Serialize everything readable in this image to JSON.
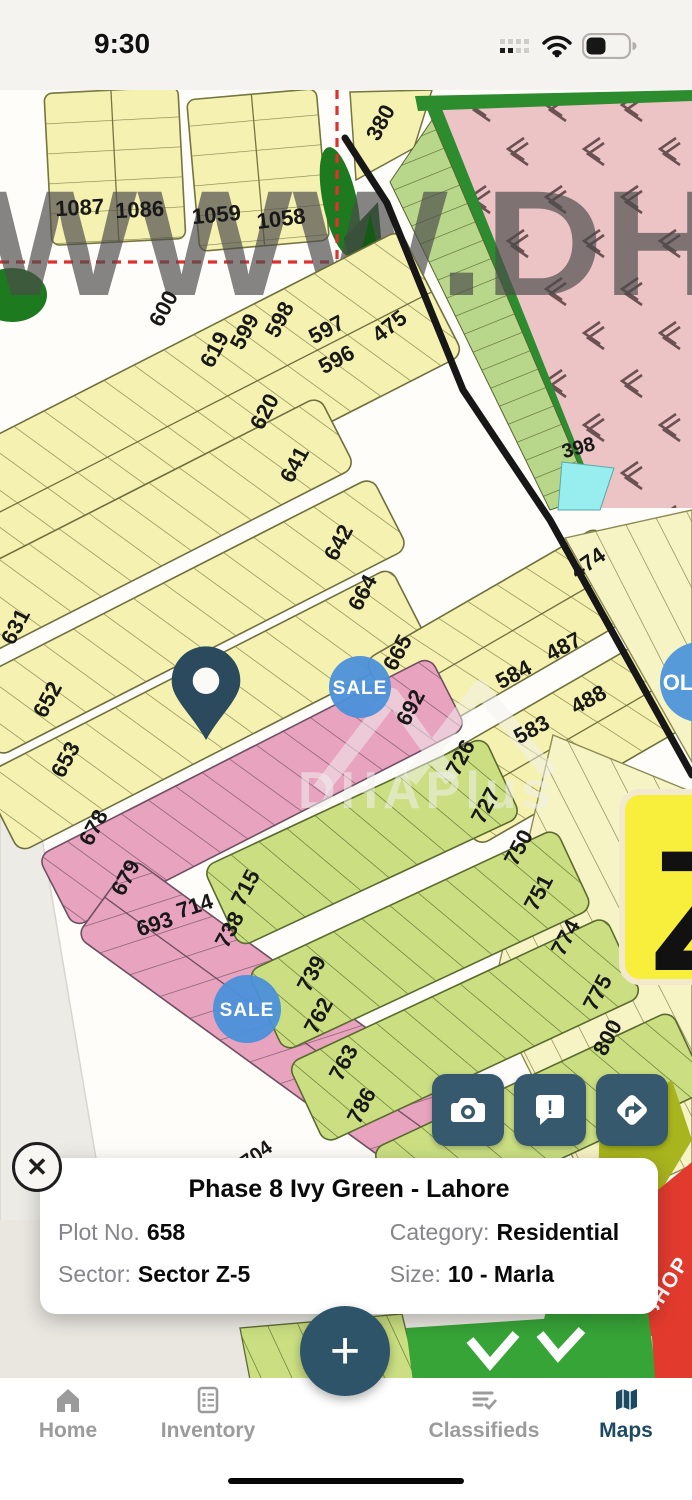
{
  "status_bar": {
    "time": "9:30"
  },
  "watermark": {
    "large": "WWW.DH",
    "brand": "DHAPlus"
  },
  "map": {
    "sale_badge": "SALE",
    "listing_badge": "OL",
    "shop_label": "SHOP",
    "sector_overlay": "Z",
    "plot_labels": [
      {
        "t": "1087",
        "x": 80,
        "y": 125,
        "r": -3
      },
      {
        "t": "1086",
        "x": 140,
        "y": 127,
        "r": -3
      },
      {
        "t": "1059",
        "x": 217,
        "y": 132,
        "r": -5
      },
      {
        "t": "1058",
        "x": 282,
        "y": 136,
        "r": -7
      },
      {
        "t": "380",
        "x": 387,
        "y": 36,
        "r": -62
      },
      {
        "t": "600",
        "x": 170,
        "y": 222,
        "r": -62
      },
      {
        "t": "619",
        "x": 221,
        "y": 263,
        "r": -62
      },
      {
        "t": "599",
        "x": 251,
        "y": 245,
        "r": -62
      },
      {
        "t": "598",
        "x": 286,
        "y": 233,
        "r": -62
      },
      {
        "t": "597",
        "x": 330,
        "y": 246,
        "r": -28
      },
      {
        "t": "596",
        "x": 340,
        "y": 276,
        "r": -28
      },
      {
        "t": "475",
        "x": 394,
        "y": 242,
        "r": -38
      },
      {
        "t": "620",
        "x": 271,
        "y": 325,
        "r": -62
      },
      {
        "t": "641",
        "x": 301,
        "y": 378,
        "r": -62
      },
      {
        "t": "631",
        "x": 22,
        "y": 540,
        "r": -62
      },
      {
        "t": "642",
        "x": 345,
        "y": 456,
        "r": -62
      },
      {
        "t": "664",
        "x": 369,
        "y": 506,
        "r": -62
      },
      {
        "t": "652",
        "x": 54,
        "y": 613,
        "r": -62
      },
      {
        "t": "653",
        "x": 72,
        "y": 673,
        "r": -62
      },
      {
        "t": "665",
        "x": 404,
        "y": 566,
        "r": -62
      },
      {
        "t": "692",
        "x": 417,
        "y": 621,
        "r": -62
      },
      {
        "t": "678",
        "x": 100,
        "y": 741,
        "r": -62
      },
      {
        "t": "679",
        "x": 132,
        "y": 791,
        "r": -62
      },
      {
        "t": "693",
        "x": 157,
        "y": 841,
        "r": -18
      },
      {
        "t": "714",
        "x": 197,
        "y": 823,
        "r": -18
      },
      {
        "t": "704",
        "x": 260,
        "y": 1070,
        "r": -35,
        "s": 20
      },
      {
        "t": "715",
        "x": 252,
        "y": 801,
        "r": -62
      },
      {
        "t": "738",
        "x": 236,
        "y": 843,
        "r": -62
      },
      {
        "t": "726",
        "x": 467,
        "y": 671,
        "r": -62
      },
      {
        "t": "727",
        "x": 492,
        "y": 719,
        "r": -62
      },
      {
        "t": "739",
        "x": 318,
        "y": 887,
        "r": -62
      },
      {
        "t": "762",
        "x": 325,
        "y": 929,
        "r": -62
      },
      {
        "t": "750",
        "x": 525,
        "y": 761,
        "r": -62
      },
      {
        "t": "751",
        "x": 545,
        "y": 806,
        "r": -62
      },
      {
        "t": "763",
        "x": 350,
        "y": 976,
        "r": -62
      },
      {
        "t": "786",
        "x": 368,
        "y": 1019,
        "r": -62
      },
      {
        "t": "774",
        "x": 572,
        "y": 851,
        "r": -62
      },
      {
        "t": "775",
        "x": 604,
        "y": 906,
        "r": -62
      },
      {
        "t": "800",
        "x": 614,
        "y": 951,
        "r": -62
      },
      {
        "t": "474",
        "x": 592,
        "y": 479,
        "r": -35
      },
      {
        "t": "584",
        "x": 517,
        "y": 591,
        "r": -28
      },
      {
        "t": "487",
        "x": 567,
        "y": 563,
        "r": -28
      },
      {
        "t": "583",
        "x": 535,
        "y": 646,
        "r": -28
      },
      {
        "t": "488",
        "x": 592,
        "y": 616,
        "r": -28
      },
      {
        "t": "398",
        "x": 580,
        "y": 364,
        "r": -15,
        "s": 20
      }
    ]
  },
  "info_card": {
    "title": "Phase 8 Ivy Green - Lahore",
    "close_label": "✕",
    "fields": [
      {
        "label": "Plot No.",
        "value": "658"
      },
      {
        "label": "Category:",
        "value": "Residential"
      },
      {
        "label": "Sector:",
        "value": "Sector Z-5"
      },
      {
        "label": "Size:",
        "value": "10 - Marla"
      }
    ]
  },
  "fab": {
    "label": "+"
  },
  "tab_bar": {
    "items": [
      {
        "label": "Home",
        "active": false
      },
      {
        "label": "Inventory",
        "active": false
      },
      {
        "label": "Classifieds",
        "active": false
      },
      {
        "label": "Maps",
        "active": true
      }
    ]
  },
  "colors": {
    "accent_slate": "#36596e",
    "pin": "#2b4a5e",
    "sale_blue": "#4b90d9",
    "plot_yellow": "#f5f1b0",
    "plot_pink": "#e8a3be",
    "plot_green": "#cbdf82",
    "cemetery_rose": "#ecc4c6",
    "border_green": "#2d8c2e",
    "active_tab": "#1d4a63"
  }
}
